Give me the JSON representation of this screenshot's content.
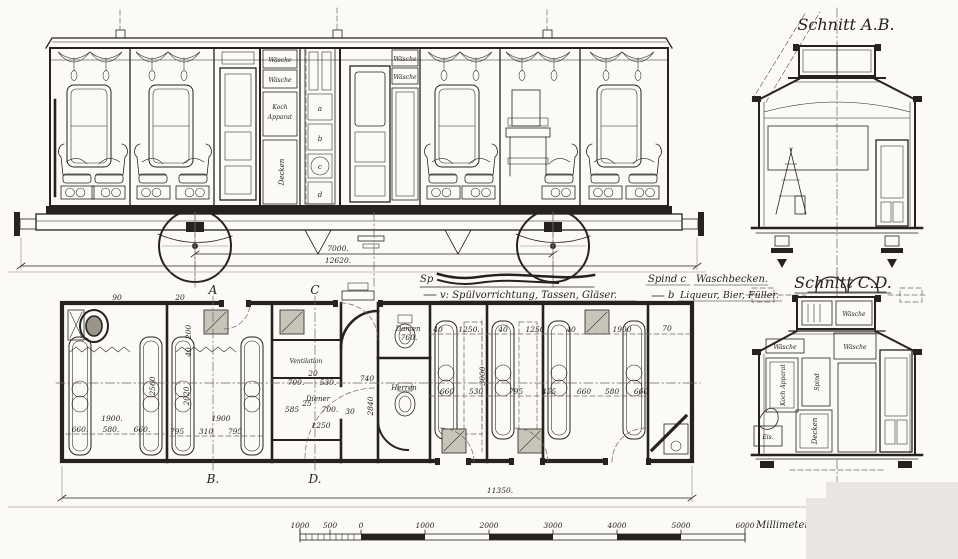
{
  "sheet": {
    "bg": "#fbfaf7",
    "ink": "#26231f"
  },
  "elevation": {
    "cabinets": {
      "w1": "Wäsche",
      "w2": "Wäsche",
      "koch1": "Koch",
      "koch2": "Apparat",
      "decken": "Decken"
    },
    "wardrobe": {
      "w3": "Wäsche",
      "w4": "Wäsche"
    },
    "lockers": [
      "a",
      "b",
      "c",
      "d"
    ],
    "dims": {
      "wheelbase": "7000.",
      "overall": "12620."
    }
  },
  "section_ab": {
    "title": "Schnitt A.B."
  },
  "section_cd": {
    "title": "Schnitt C.D.",
    "labels": {
      "waesche_small": "Wäsche",
      "waesche_1": "Wäsche",
      "waesche_2": "Wäsche",
      "panel_1": "Koch Apparat",
      "panel_2": "Spind",
      "decken": "Decken",
      "eis": "Eis."
    }
  },
  "legend": {
    "sp": "Sp",
    "line2": "v: Spülvorrichtung, Tassen, Gläser.",
    "right1a": "Spind c",
    "right1b": "Waschbecken.",
    "right2a": "b",
    "right2b": "Liqueur, Bier, Füller."
  },
  "plan": {
    "rooms": {
      "ventilation": "Ventilation",
      "diener": "Diener",
      "damen": "Damen",
      "damen_w": "760.",
      "herren": "Herren"
    },
    "marks": {
      "a_top": "A",
      "c_top": "C",
      "b_bottom": "B.",
      "d_bottom": "D."
    },
    "overall": "11350.",
    "dims": {
      "d90": "90",
      "d20": "20",
      "v200": "200",
      "v40": "40",
      "v2560": "2560",
      "v2020": "2020",
      "v2840": "2840",
      "v3000": "3000",
      "w1900a": "1900.",
      "w1900b": "1900",
      "w1900r": "1900",
      "r1a": "660.",
      "r1b": "580.",
      "r1c": "660.",
      "r2a": "795",
      "r2b": "310",
      "r2c": "795",
      "m700a": "700.",
      "m530": "530.",
      "m20": "20",
      "m740": "740",
      "m25": "25",
      "m585": "585",
      "m700b": "700.",
      "m30": "30",
      "m1250": "1250",
      "t40a": "40",
      "t1250a": "1250.",
      "t40b": "40",
      "t1250b": "1250",
      "t40c": "40",
      "t70": "70",
      "b660a": "660",
      "b530": "530",
      "b795": "795",
      "b455": "455",
      "b660b": "660",
      "b580": "580",
      "b660c": "660"
    }
  },
  "scale": {
    "left": [
      "1000",
      "500",
      "0"
    ],
    "right": [
      "1000",
      "2000",
      "3000",
      "4000",
      "5000",
      "6000"
    ],
    "unit": "Millimeter"
  }
}
